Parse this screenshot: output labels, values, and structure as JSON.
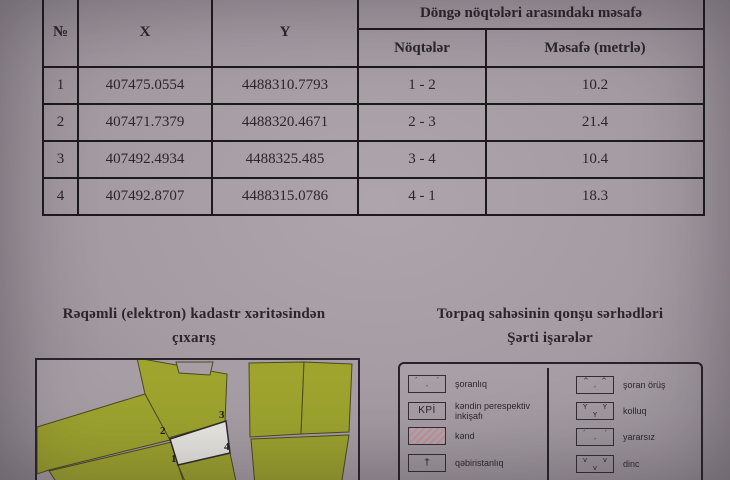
{
  "colors": {
    "background": "#a49ba2",
    "table_line": "#1d1a1c",
    "parcel_green": "#9ea42e",
    "highlight_parcel": "#e9e8e2",
    "hatch_pink": "#c2939c"
  },
  "table": {
    "headers": {
      "no": "№",
      "x": "X",
      "y": "Y",
      "distance_group": "Döngə nöqtələri arasındakı məsafə",
      "points": "Nöqtələr",
      "distance": "Məsafə (metrlə)"
    },
    "rows": [
      {
        "no": "1",
        "x": "407475.0554",
        "y": "4488310.7793",
        "points": "1 - 2",
        "distance": "10.2"
      },
      {
        "no": "2",
        "x": "407471.7379",
        "y": "4488320.4671",
        "points": "2 - 3",
        "distance": "21.4"
      },
      {
        "no": "3",
        "x": "407492.4934",
        "y": "4488325.485",
        "points": "3 - 4",
        "distance": "10.4"
      },
      {
        "no": "4",
        "x": "407492.8707",
        "y": "4488315.0786",
        "points": "4 - 1",
        "distance": "18.3"
      }
    ]
  },
  "map_section": {
    "title_line1": "Rəqəmli (elektron) kadastr xəritəsindən",
    "title_line2": "çıxarış",
    "points": [
      "1",
      "2",
      "3",
      "4"
    ]
  },
  "legend_section": {
    "title_line1": "Torpaq sahəsinin qonşu sərhədləri",
    "title_line2": "Şərti işarələr",
    "left_items": [
      {
        "label": "şoranlıq",
        "sym": {
          "a": "ʼ",
          "b": "ʼ",
          "c": "ʼ"
        }
      },
      {
        "label": "kəndin perespektiv inkişafı",
        "text": "KPİ"
      },
      {
        "label": "kənd"
      },
      {
        "label": "qəbiristanlıq",
        "text": "†"
      }
    ],
    "right_items": [
      {
        "label": "şoran örüş",
        "sym": {
          "a": "^",
          "b": "^",
          "c": "ʼ"
        }
      },
      {
        "label": "kolluq",
        "sym": {
          "a": "Y",
          "b": "Y",
          "c": "Y"
        }
      },
      {
        "label": "yararsız",
        "sym": {
          "a": "ʼ",
          "b": "ʼ",
          "c": "ʼ"
        }
      },
      {
        "label": "dinc",
        "sym": {
          "a": "v",
          "b": "v",
          "c": "v"
        }
      }
    ]
  }
}
